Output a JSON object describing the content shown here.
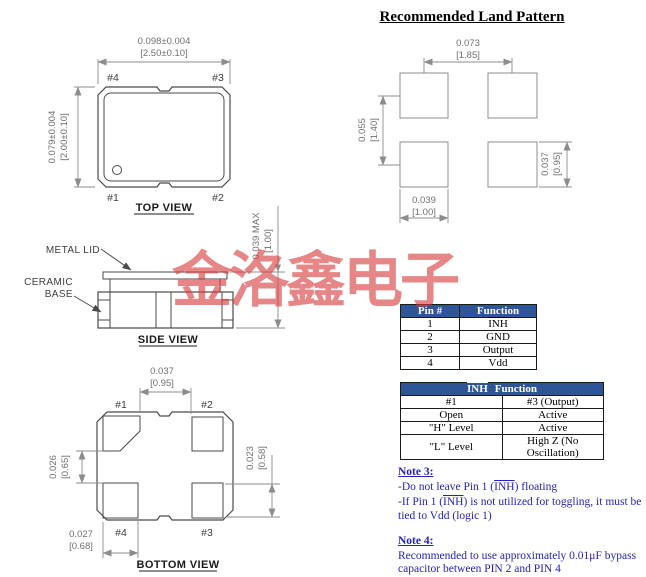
{
  "watermark": {
    "text": "金洛鑫电子",
    "color": "#d93b3b"
  },
  "land_pattern": {
    "title": "Recommended Land Pattern",
    "dim_top_in": "0.073",
    "dim_top_mm": "[1.85]",
    "dim_left_in": "0.055",
    "dim_left_mm": "[1.40]",
    "dim_right_in": "0.037",
    "dim_right_mm": "[0.95]",
    "dim_bottom_in": "0.039",
    "dim_bottom_mm": "[1.00]"
  },
  "top_view": {
    "label": "TOP VIEW",
    "dim_width_in": "0.098±0.004",
    "dim_width_mm": "[2.50±0.10]",
    "dim_height_in": "0.079±0.004",
    "dim_height_mm": "[2.00±0.10]",
    "pin_tl": "#4",
    "pin_tr": "#3",
    "pin_bl": "#1",
    "pin_br": "#2"
  },
  "side_view": {
    "label": "SIDE VIEW",
    "metal_lid": "METAL LID",
    "ceramic_line1": "CERAMIC",
    "ceramic_line2": "BASE",
    "dim_height_in": "0.039  MAX",
    "dim_height_mm": "[1.00]"
  },
  "bottom_view": {
    "label": "BOTTOM VIEW",
    "pin_tl": "#1",
    "pin_tr": "#2",
    "pin_bl": "#4",
    "pin_br": "#3",
    "dim_top_in": "0.037",
    "dim_top_mm": "[0.95]",
    "dim_left_in": "0.026",
    "dim_left_mm": "[0.65]",
    "dim_right_in": "0.023",
    "dim_right_mm": "[0.58]",
    "dim_bottom_in": "0.027",
    "dim_bottom_mm": "[0.68]"
  },
  "pin_table": {
    "headers": [
      "Pin #",
      "Function"
    ],
    "rows": [
      {
        "pin": "1",
        "fn": "INH"
      },
      {
        "pin": "2",
        "fn": "GND"
      },
      {
        "pin": "3",
        "fn": "Output"
      },
      {
        "pin": "4",
        "fn": "Vdd"
      }
    ]
  },
  "inh_table": {
    "title_inh": "INH",
    "title_rest": "Function",
    "rows": [
      {
        "c1": "#1",
        "c2": "#3 (Output)"
      },
      {
        "c1": "Open",
        "c2": "Active"
      },
      {
        "c1": "\"H\" Level",
        "c2": "Active"
      },
      {
        "c1": "\"L\" Level",
        "c2": "High Z (No Oscillation)"
      }
    ]
  },
  "notes": {
    "note3_title": "Note 3:",
    "note3_line1_pre": "-Do not leave Pin 1 (",
    "note3_inh": "INH",
    "note3_line1_post": ") floating",
    "note3_line2_pre": "-If Pin 1 (",
    "note3_line2_post": ") is not utilized for toggling, it must be tied to Vdd (logic 1)",
    "note4_title": "Note 4:",
    "note4_text": "Recommended to use approximately 0.01μF bypass capacitor between PIN 2 and PIN 4"
  },
  "colors": {
    "table_header_bg": "#2e5596",
    "note_blue": "#2323be",
    "line_gray": "#4a4a4a"
  }
}
